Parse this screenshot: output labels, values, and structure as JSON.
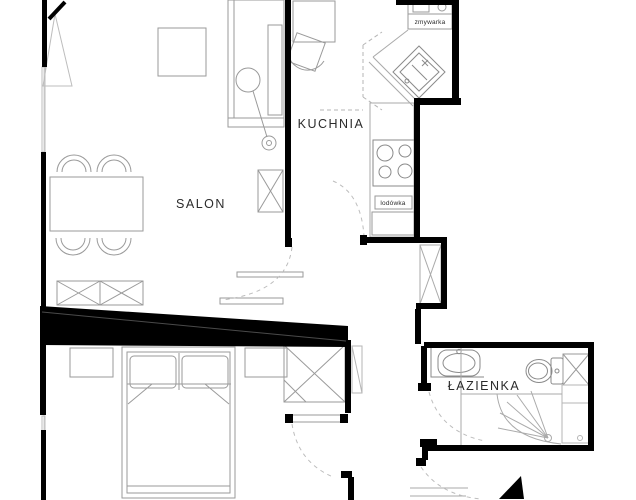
{
  "plan": {
    "type": "apartment-floor-plan",
    "rooms": [
      {
        "id": "salon",
        "label": "SALON"
      },
      {
        "id": "kuchnia",
        "label": "KUCHNIA"
      },
      {
        "id": "lazienka",
        "label": "ŁAZIENKA"
      }
    ],
    "appliances": [
      {
        "id": "zmywarka",
        "label": "zmywarka"
      },
      {
        "id": "lodowka",
        "label": "lodówka"
      }
    ],
    "colors": {
      "wall": "#000000",
      "line": "#9a9a9a",
      "line_light": "#bdbdbd",
      "text": "#2b2b2b",
      "background": "#ffffff"
    }
  }
}
